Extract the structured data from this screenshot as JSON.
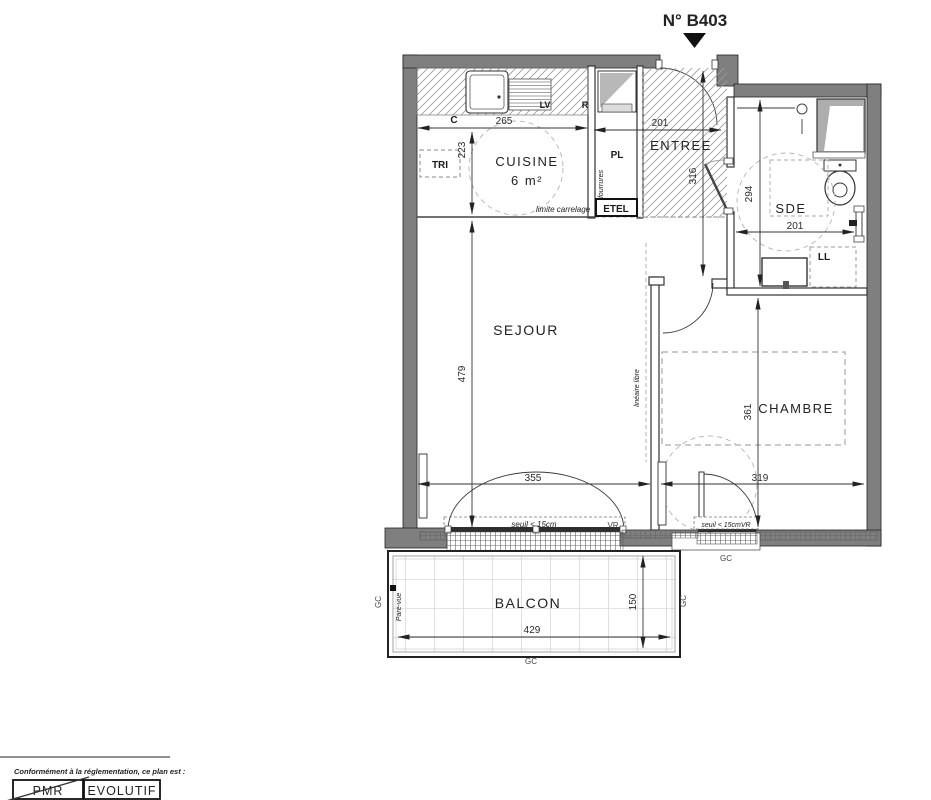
{
  "title": "N° B403",
  "colors": {
    "wall": "#7f7f7f",
    "title": "#33337a",
    "room_label": "#474f58",
    "annotation": "#4a5a68",
    "dim": "#222222"
  },
  "rooms": {
    "cuisine": "CUISINE",
    "cuisine_area": "6 m²",
    "entree": "ENTREE",
    "sde": "SDE",
    "sejour": "SEJOUR",
    "chambre": "CHAMBRE",
    "balcon": "BALCON"
  },
  "dims": {
    "d265": "265",
    "d223": "223",
    "d201_entree": "201",
    "d316": "316",
    "d294": "294",
    "d201_sde": "201",
    "d479": "479",
    "d355": "355",
    "d361": "361",
    "d319": "319",
    "d429": "429",
    "d150": "150"
  },
  "labels": {
    "c": "C",
    "tri": "TRI",
    "lv": "LV",
    "r": "R",
    "pl": "PL",
    "etel": "ETEL",
    "ll": "LL",
    "vr": "VR",
    "gc": "GC"
  },
  "annotations": {
    "limite_carrelage": "limite carrelage",
    "fourrures": "fourrures",
    "lineaire_libre": "linéaire libre",
    "pare_vue": "Pare-vue",
    "seuil_sejour": "seuil < 15cm",
    "seuil_chambre": "seuil < 15cmVR"
  },
  "legend": {
    "caption": "Conformément à la réglementation, ce plan est :",
    "pmr": "PMR",
    "evolutif": "EVOLUTIF"
  }
}
